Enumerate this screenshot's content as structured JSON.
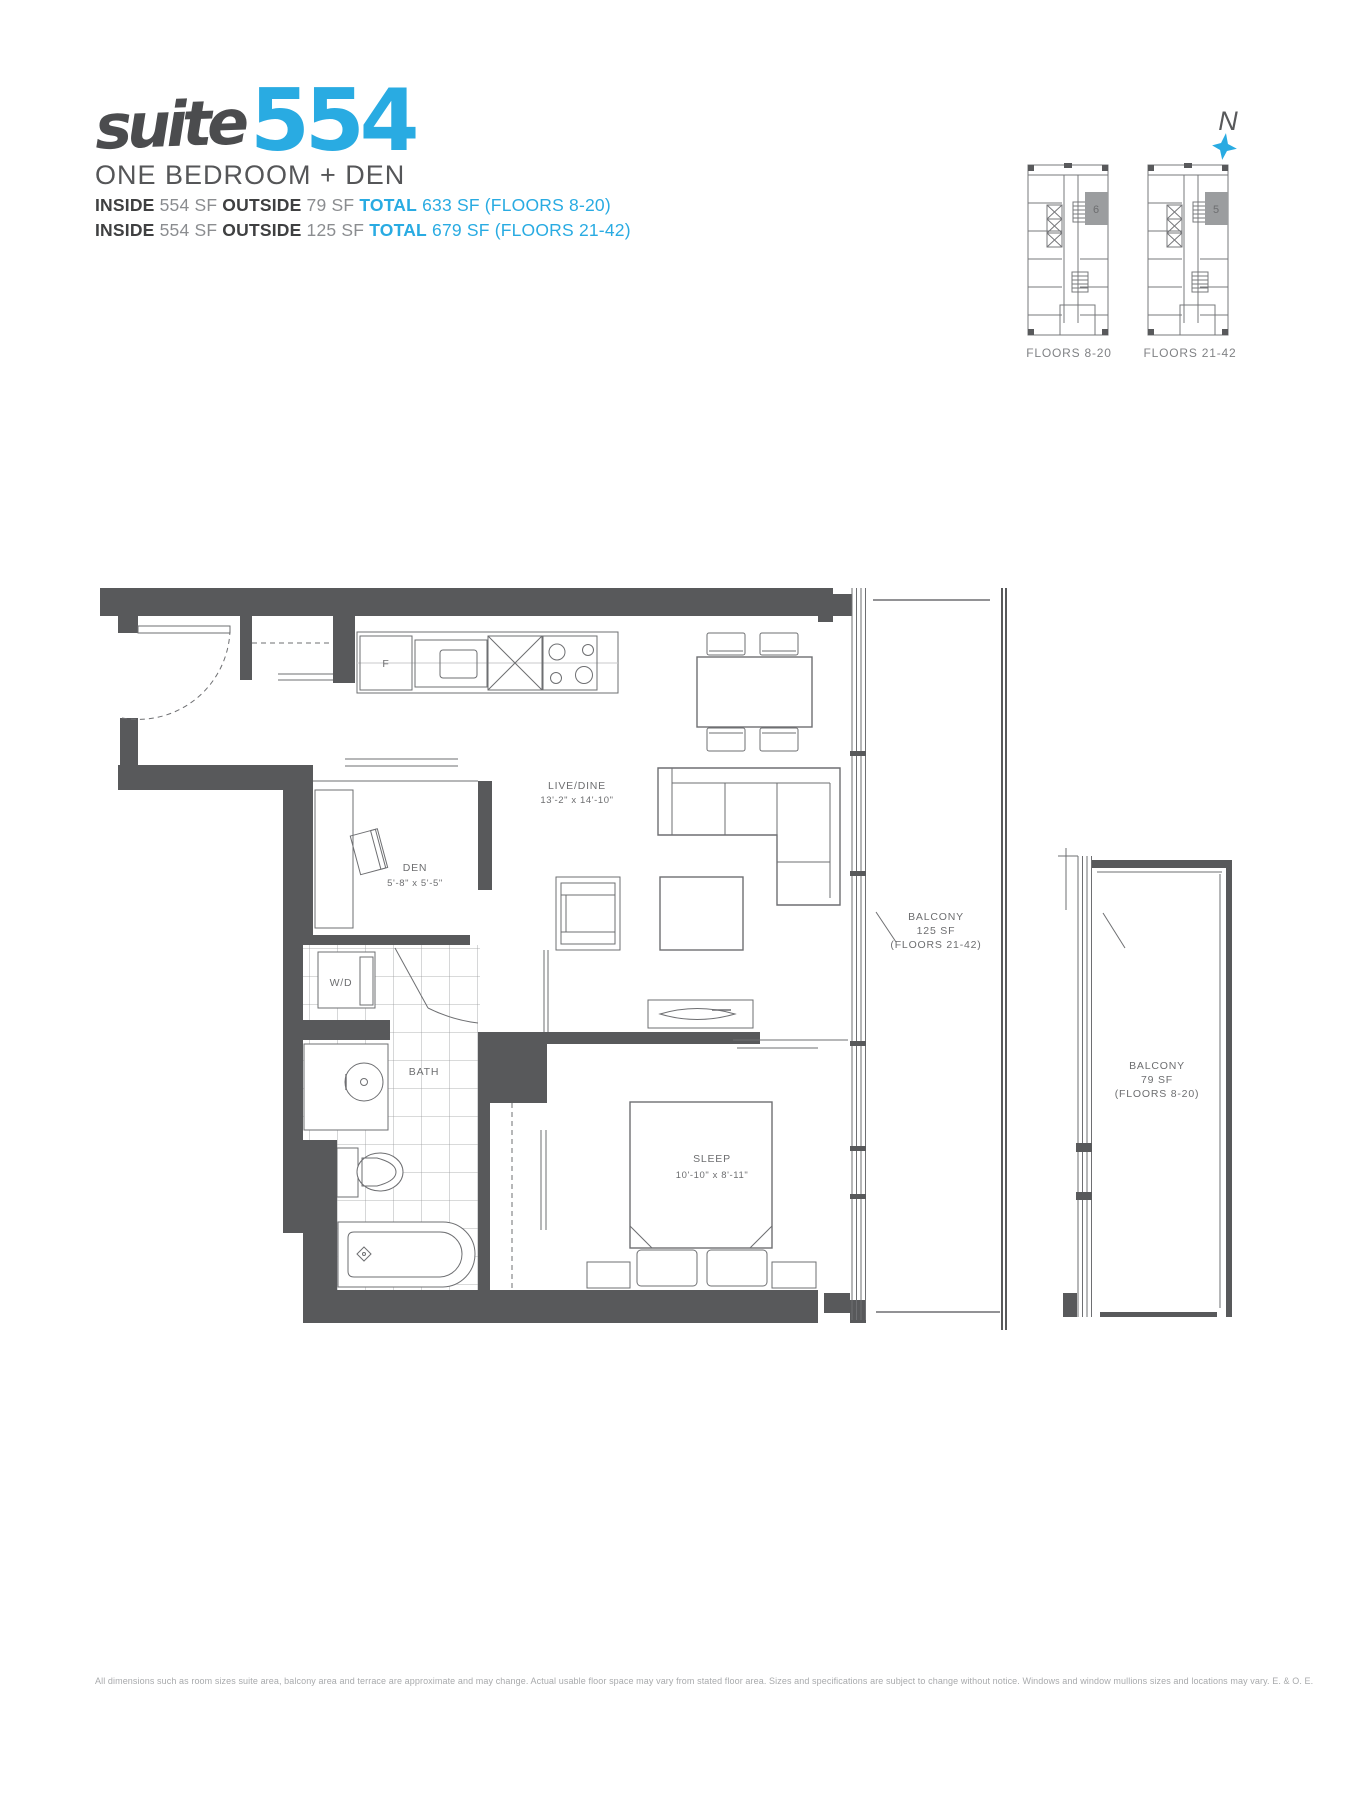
{
  "header": {
    "title_script": "suite",
    "title_number": "554",
    "subtitle": "ONE BEDROOM + DEN",
    "line1": {
      "inside_label": "INSIDE",
      "inside_value": "554 SF",
      "outside_label": "OUTSIDE",
      "outside_value": "79 SF",
      "total_label": "TOTAL",
      "total_value": "633 SF (FLOORS 8-20)"
    },
    "line2": {
      "inside_label": "INSIDE",
      "inside_value": "554 SF",
      "outside_label": "OUTSIDE",
      "outside_value": "125 SF",
      "total_label": "TOTAL",
      "total_value": "679 SF (FLOORS 21-42)"
    }
  },
  "compass": {
    "north_label": "N"
  },
  "keyplans": {
    "plans": [
      {
        "unit": "6",
        "label": "FLOORS 8-20"
      },
      {
        "unit": "5",
        "label": "FLOORS 21-42"
      }
    ]
  },
  "floorplan": {
    "rooms": {
      "live_dine": {
        "name": "LIVE/DINE",
        "dims": "13'-2\" x 14'-10\""
      },
      "den": {
        "name": "DEN",
        "dims": "5'-8\" x 5'-5\""
      },
      "sleep": {
        "name": "SLEEP",
        "dims": "10'-10\" x 8'-11\""
      },
      "bath": {
        "name": "BATH"
      },
      "wd": {
        "name": "W/D"
      },
      "fridge": {
        "name": "F"
      }
    },
    "balconies": [
      {
        "name": "BALCONY",
        "area": "125 SF",
        "floors": "(FLOORS 21-42)"
      },
      {
        "name": "BALCONY",
        "area": "79 SF",
        "floors": "(FLOORS 8-20)"
      }
    ]
  },
  "footer": {
    "disclaimer": "All dimensions such as room sizes suite area, balcony area and terrace are approximate and may change. Actual usable floor space may vary from stated floor area. Sizes and specifications are subject to change without notice. Windows and window mullions sizes and locations may vary. E. & O. E."
  },
  "colors": {
    "accent": "#29abe2",
    "wall": "#58595b",
    "line": "#6e6f72",
    "muted": "#808285",
    "highlight_unit": "#9b9d9f"
  }
}
